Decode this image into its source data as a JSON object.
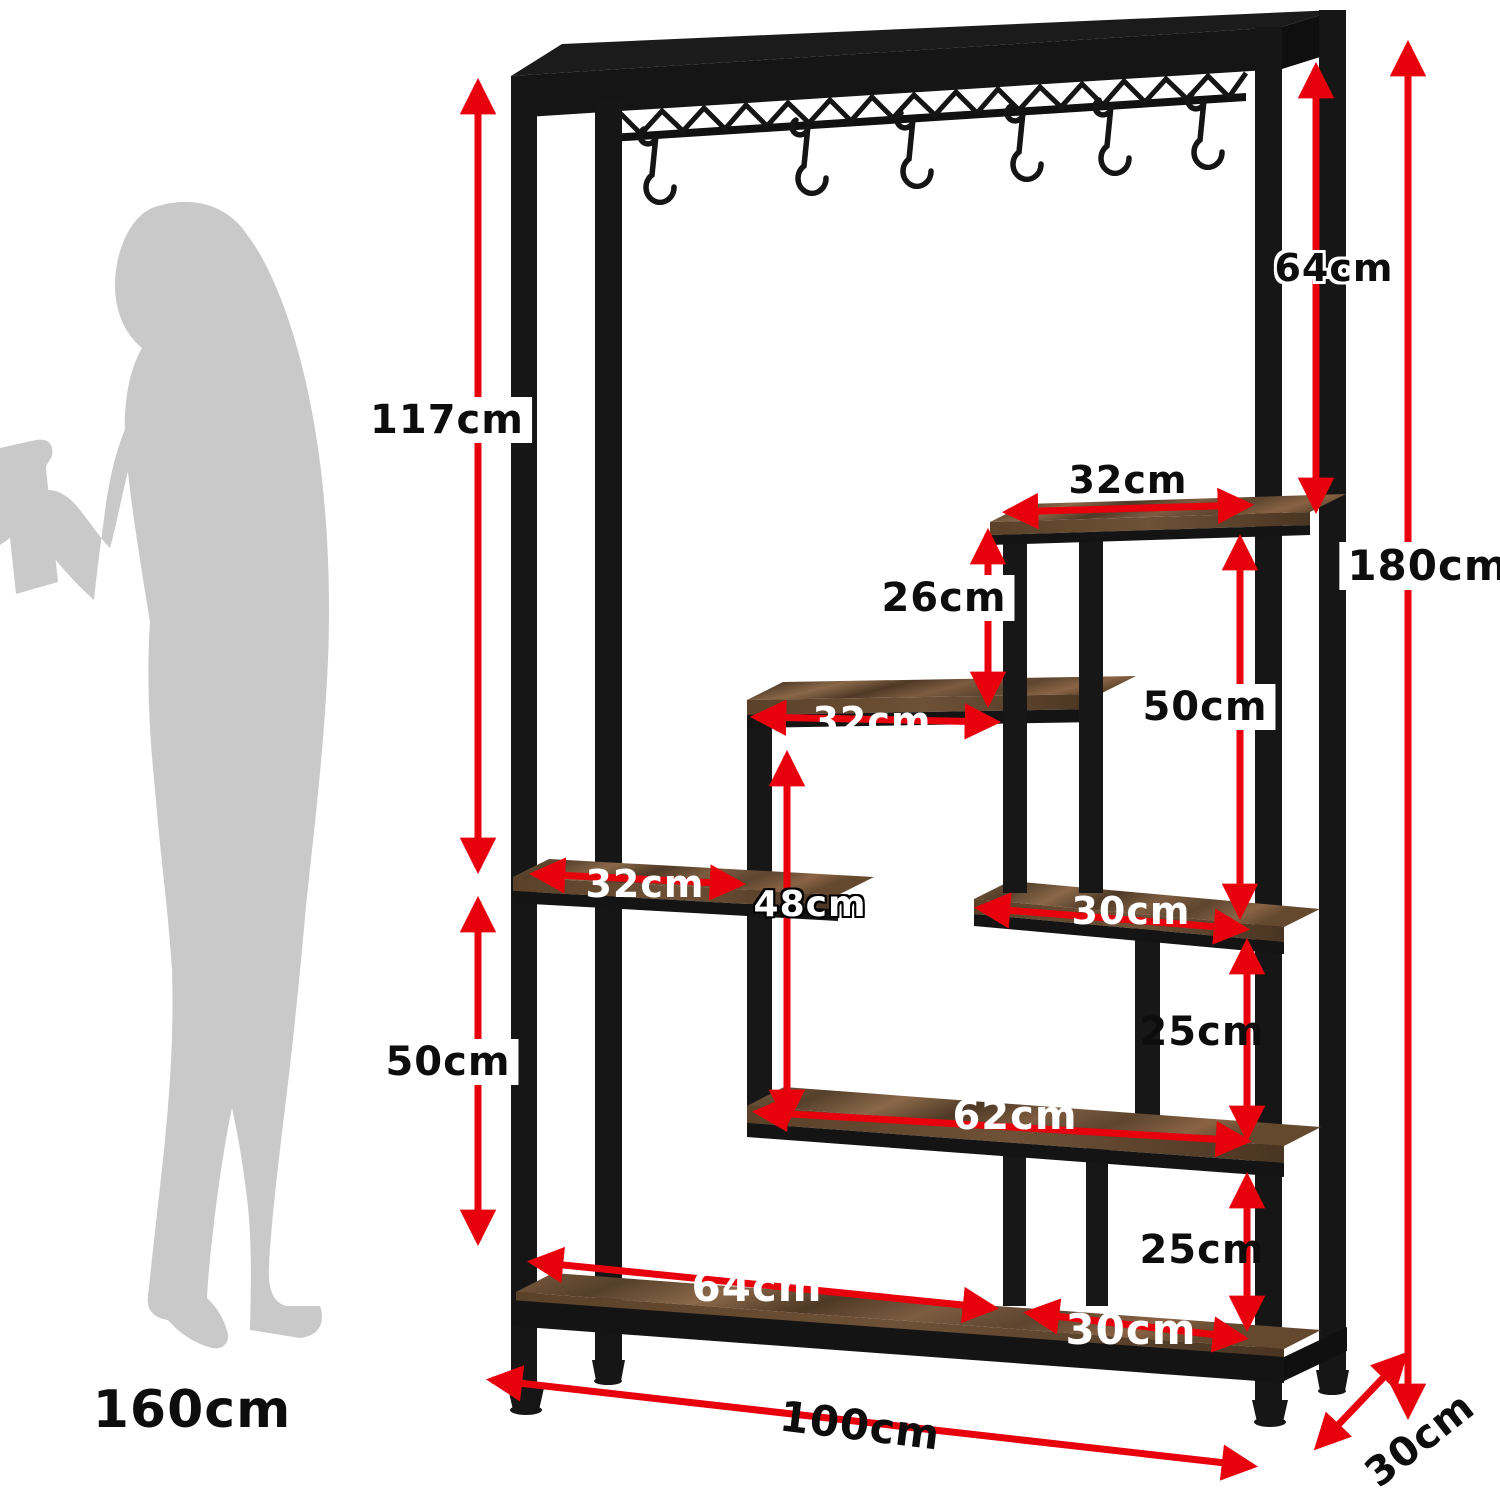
{
  "diagram": {
    "kind": "furniture dimension diagram",
    "hooks_count": 6,
    "shelf_count": 6
  },
  "labels": {
    "height_117": "117cm",
    "left_lower_50": "50cm",
    "top_right_64": "64cm",
    "total_height_180": "180cm",
    "top_shelf_32": "32cm",
    "gap_26": "26cm",
    "right_upper_50": "50cm",
    "middle_shelf_32": "32cm",
    "inner_48": "48cm",
    "left_shelf_32": "32cm",
    "right_shelf_30": "30cm",
    "gap_upper_25": "25cm",
    "long_shelf_62": "62cm",
    "gap_lower_25": "25cm",
    "bottom_shelf_64": "64cm",
    "bottom_right_30": "30cm",
    "total_width_100": "100cm",
    "depth_30": "30cm",
    "person_height_160": "160cm"
  },
  "colors": {
    "arrow_red": "#E8000D",
    "metal_black": "#161616",
    "wood_brown": "#6E5138",
    "silhouette_gray": "#C9C9C9",
    "background": "#FFFFFF"
  }
}
